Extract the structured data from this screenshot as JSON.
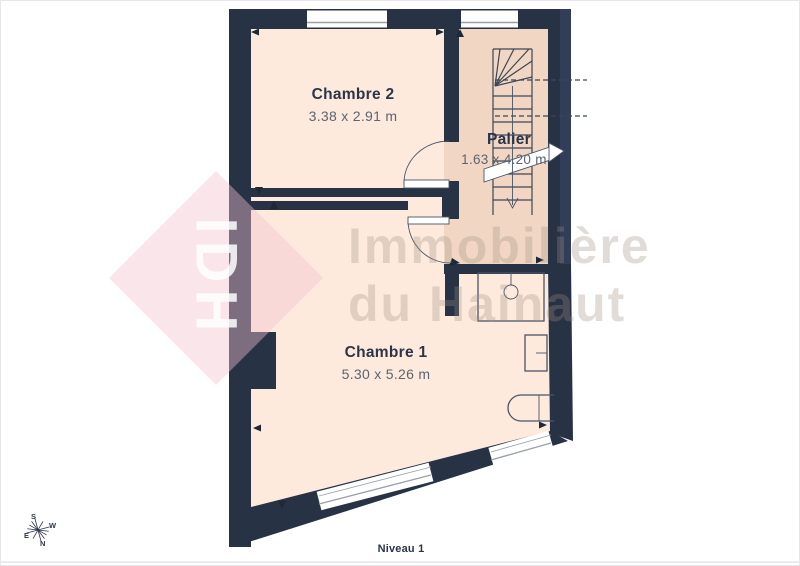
{
  "rooms": [
    {
      "name": "Chambre 2",
      "dims": "3.38 x 2.91 m"
    },
    {
      "name": "Palier",
      "dims": "1.63 x 4.20 m"
    },
    {
      "name": "Chambre 1",
      "dims": "5.30 x 5.26 m"
    }
  ],
  "level_label": "Niveau 1",
  "watermark": {
    "logo_text": "IDH",
    "line1": "Immobilière",
    "line2": "du Hainaut"
  },
  "compass": {
    "n": "N",
    "s": "S",
    "e": "E",
    "w": "W"
  },
  "colors": {
    "wall": "#273245",
    "wall_light": "#323e59",
    "room": "#fdeadc",
    "palier": "#f1d7c3",
    "line": "#4a5568",
    "text": "#2b3548",
    "dim_text": "#5b6472",
    "pink": "#f4c2d0",
    "watermark": "#a08f82",
    "white": "#ffffff",
    "hairline": "#d6d6db"
  }
}
